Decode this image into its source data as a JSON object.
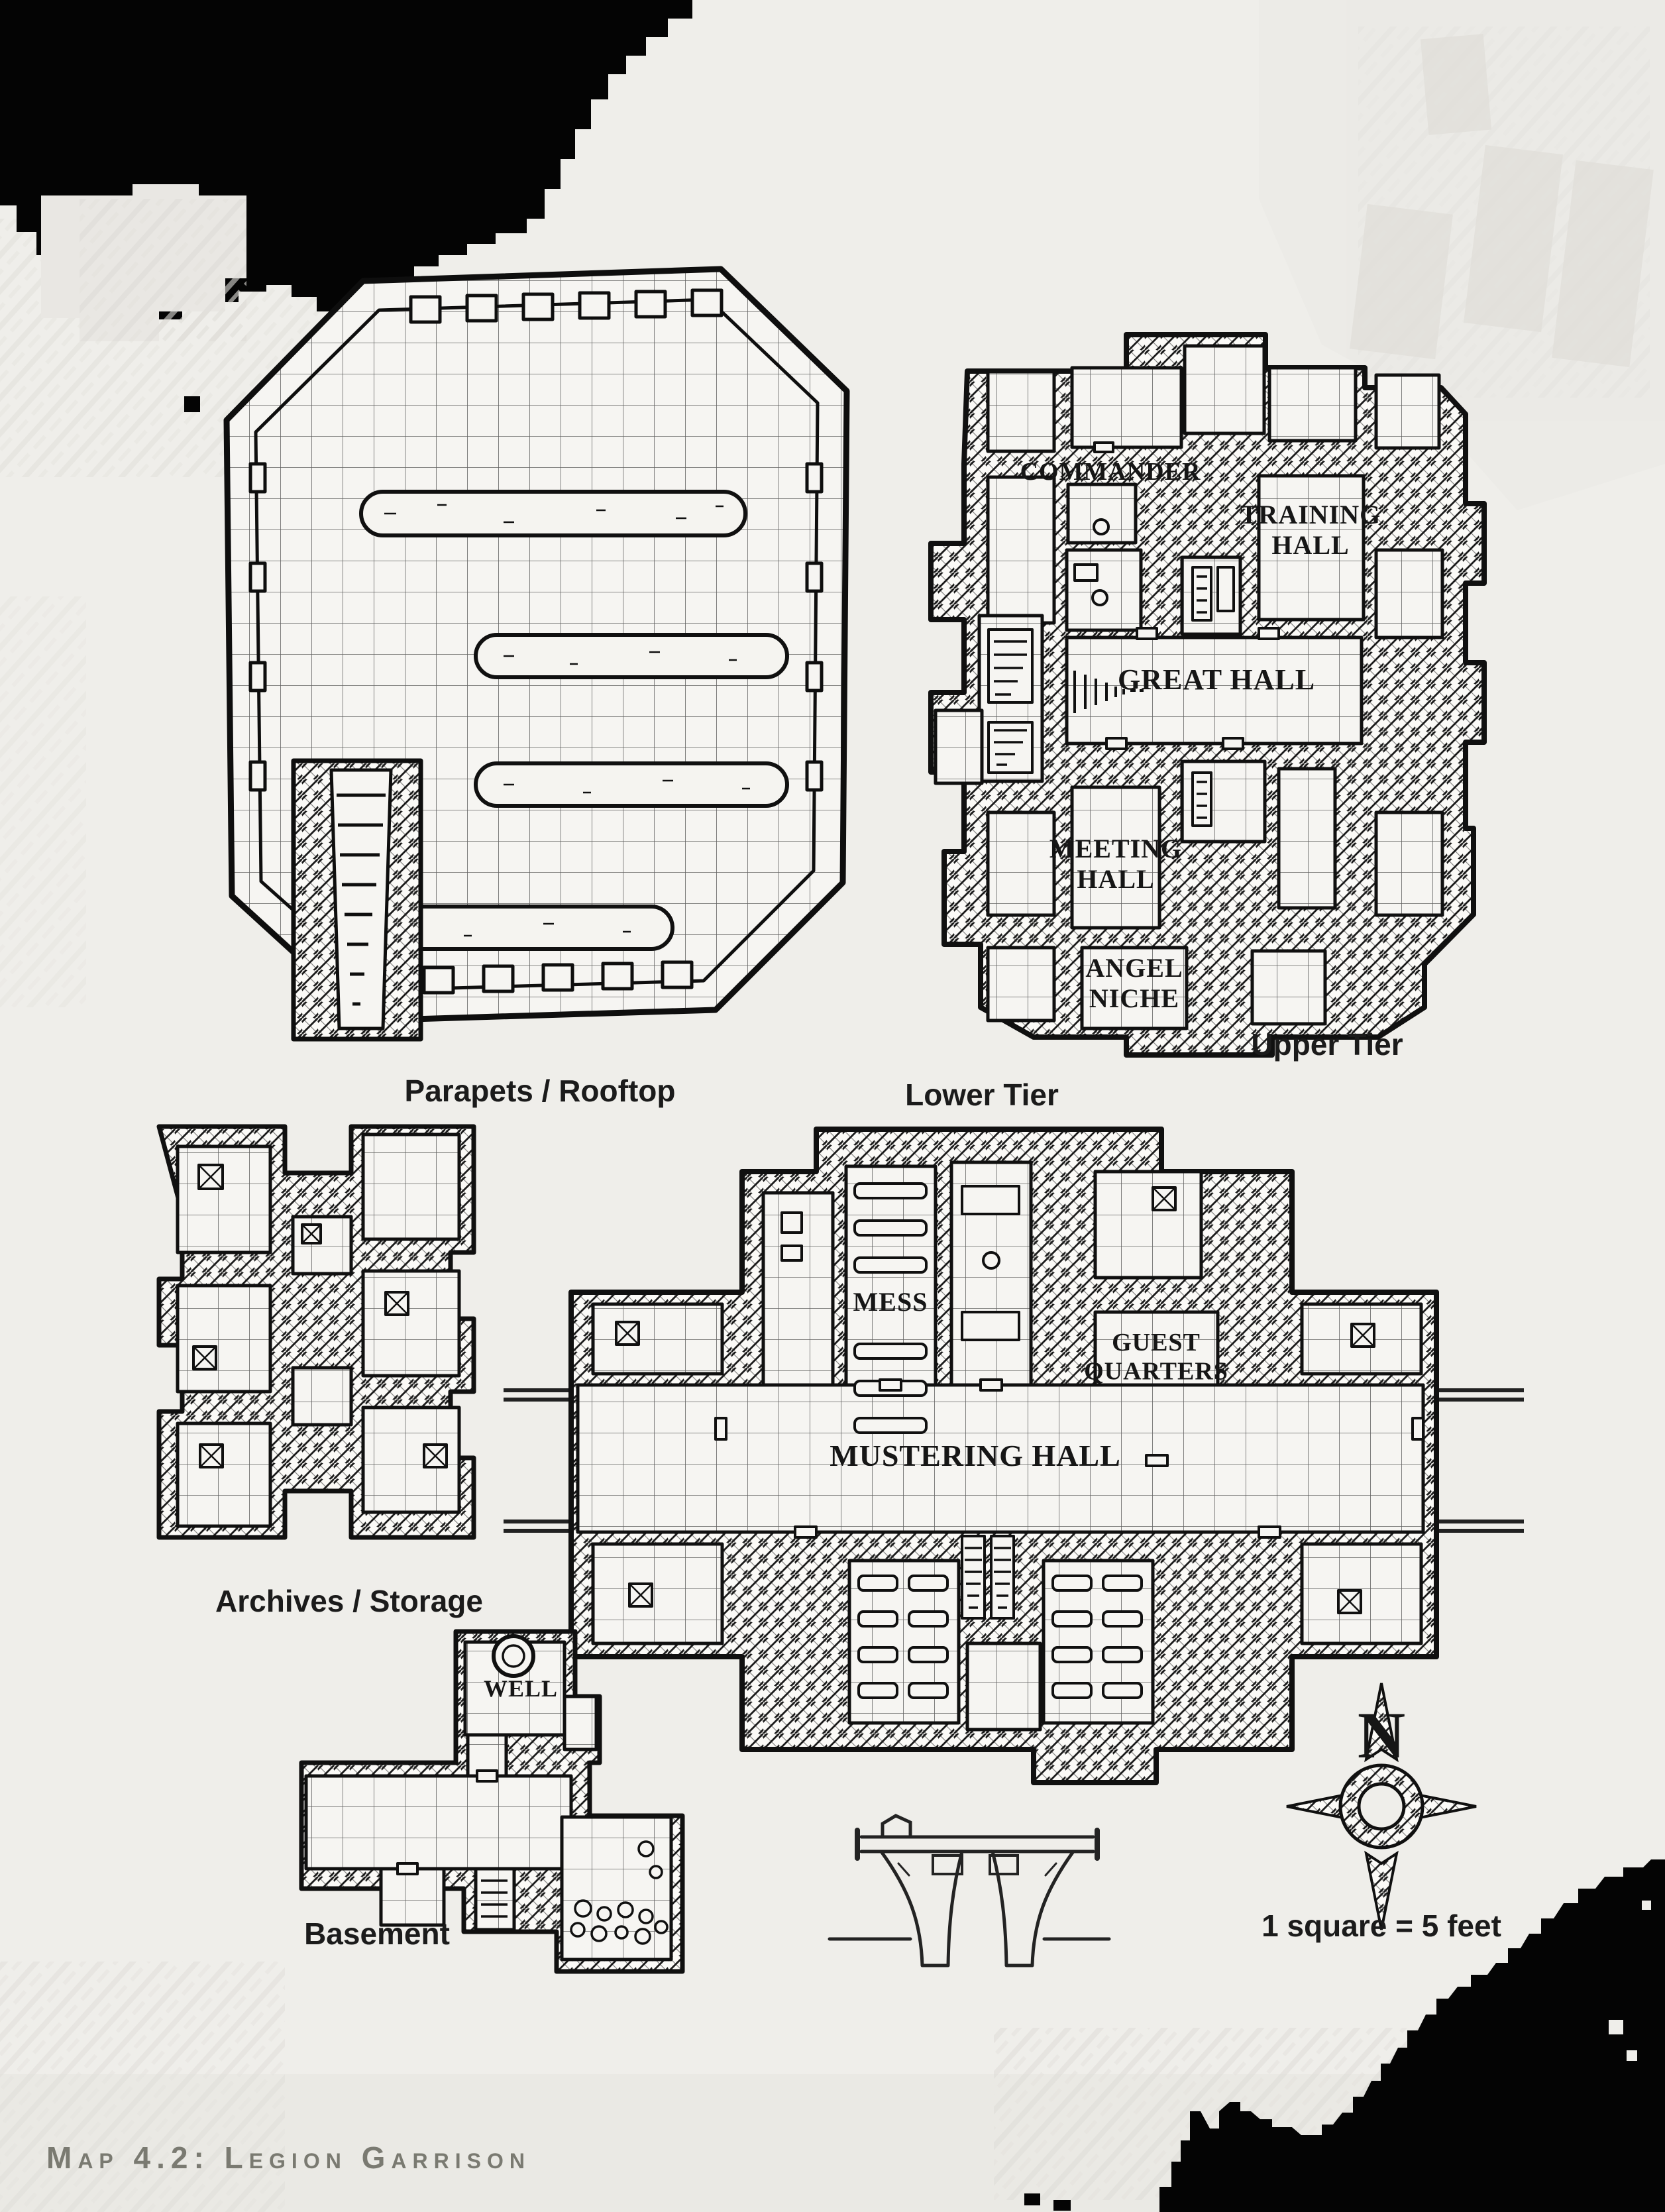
{
  "page": {
    "caption": "Map 4.2: Legion Garrison",
    "scale_note": "1 square = 5 feet",
    "compass": {
      "north_letter": "N"
    }
  },
  "levels": {
    "parapets": {
      "label": "Parapets / Rooftop"
    },
    "upper_tier": {
      "label": "Upper Tier",
      "rooms": {
        "commander": "COMMANDER",
        "training_hall": "TRAINING\nHALL",
        "great_hall": "GREAT HALL",
        "meeting_hall": "MEETING\nHALL",
        "angel_niche": "ANGEL\nNICHE"
      }
    },
    "lower_tier": {
      "label": "Lower Tier",
      "rooms": {
        "mess": "MESS",
        "guest_quarters": "GUEST\nQUARTERS",
        "mustering_hall": "MUSTERING HALL"
      }
    },
    "archives": {
      "label": "Archives / Storage"
    },
    "basement": {
      "label": "Basement",
      "rooms": {
        "well": "WELL"
      }
    }
  },
  "colors": {
    "paper": "#efeeea",
    "ink": "#141414",
    "caption_text": "#7a7a71"
  }
}
